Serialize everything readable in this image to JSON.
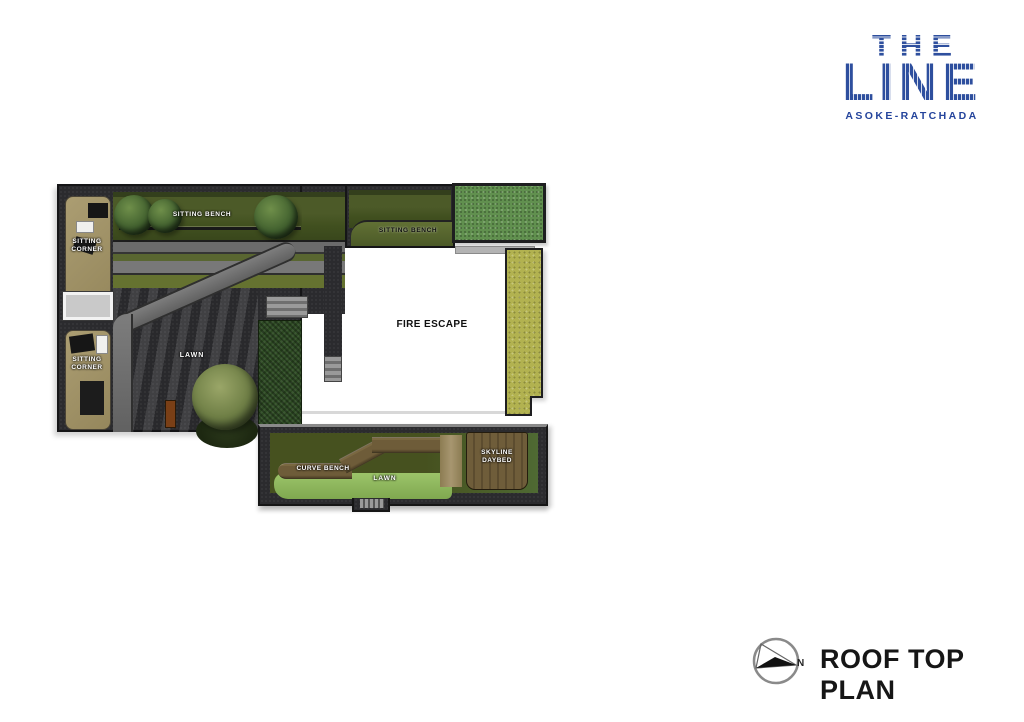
{
  "brand": {
    "name_top": "THE",
    "name_main": "LINE",
    "subtitle": "ASOKE-RATCHADA",
    "color": "#2e4f9e"
  },
  "titleblock": {
    "drawing_title": "ROOF TOP PLAN",
    "north_label": "N"
  },
  "plan": {
    "areas": {
      "sitting_bench_top": {
        "label": "SITTING BENCH"
      },
      "sitting_bench_corner": {
        "label": "SITTING BENCH"
      },
      "sitting_corner_upper": {
        "label": "SITTING CORNER"
      },
      "sitting_corner_lower": {
        "label": "SITTING CORNER"
      },
      "fire_escape": {
        "label": "FIRE ESCAPE"
      },
      "lawn_main": {
        "label": "LAWN"
      },
      "curve_bench": {
        "label": "CURVE BENCH"
      },
      "lawn_lower": {
        "label": "LAWN"
      },
      "skyline_daybed": {
        "label": "SKYLINE DAYBED"
      }
    },
    "colors": {
      "paving_dark": "#2b2b2e",
      "planting_olive": "#45511f",
      "lawn_green": "#9dc162",
      "grass_bright": "#61904f",
      "grass_yellow": "#b2b250",
      "path_gray": "#6f6f72",
      "deck_tan": "#a39469",
      "bench_brown": "#6e5c39",
      "hedge_dark_green": "#2d4a23"
    }
  }
}
